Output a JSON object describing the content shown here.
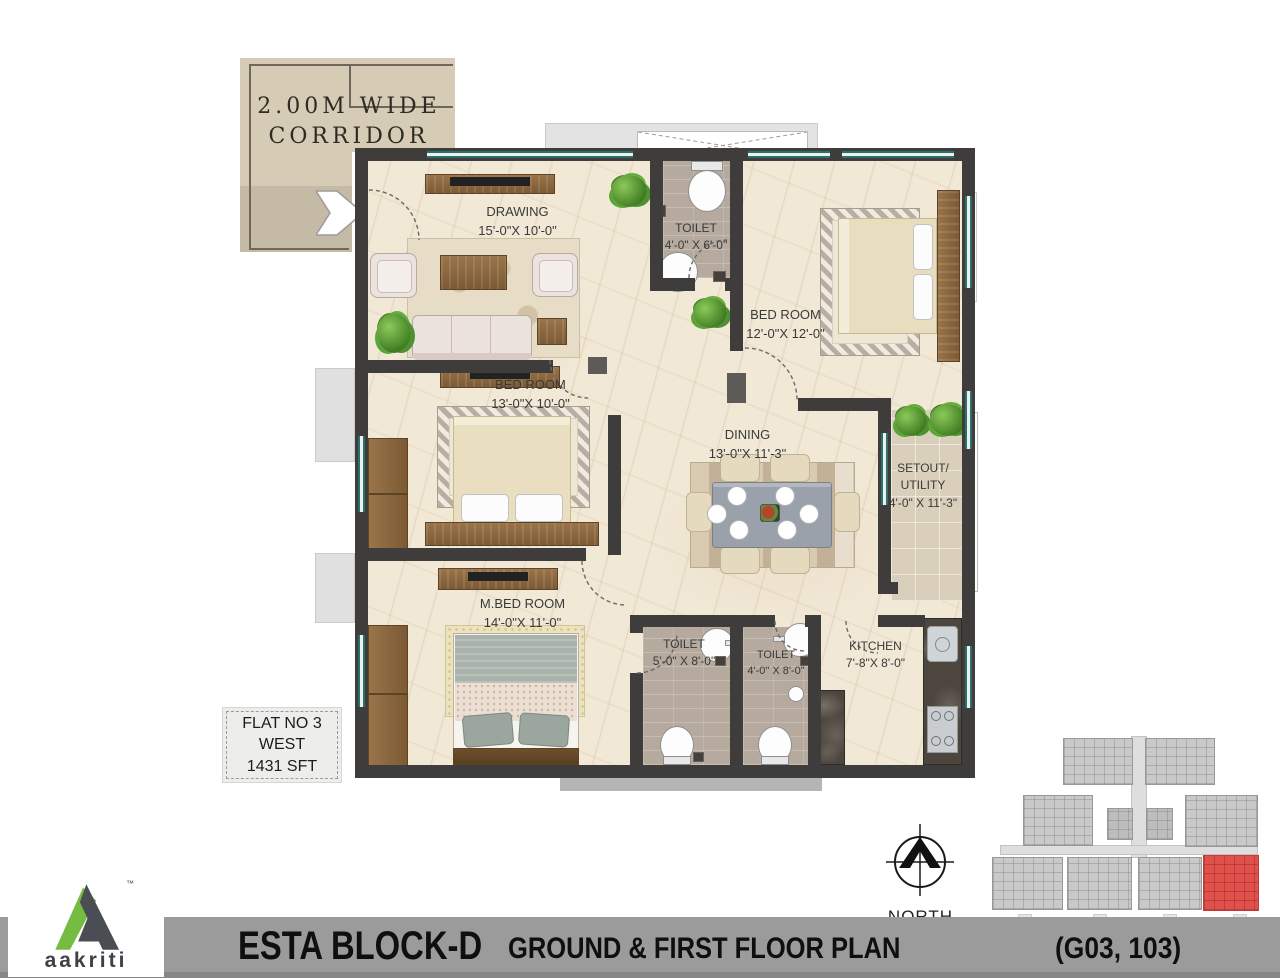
{
  "corridor": {
    "label_line1": "2.00M WIDE",
    "label_line2": "CORRIDOR"
  },
  "rooms": {
    "drawing": {
      "name": "DRAWING",
      "size": "15'-0\"X 10'-0\""
    },
    "toilet_top": {
      "name": "TOILET",
      "size": "4'-0\" X 6'-0\""
    },
    "bedroom1": {
      "name": "BED ROOM",
      "size": "12'-0\"X 12'-0\""
    },
    "bedroom2": {
      "name": "BED ROOM",
      "size": "13'-0\"X 10'-0\""
    },
    "dining": {
      "name": "DINING",
      "size": "13'-0\"X 11'-3\""
    },
    "setout": {
      "name_line1": "SETOUT/",
      "name_line2": "UTILITY",
      "size": "4'-0\" X 11'-3\""
    },
    "master_bedroom": {
      "name": "M.BED ROOM",
      "size": "14'-0\"X 11'-0\""
    },
    "toilet2": {
      "name": "TOILET",
      "size": "5'-0\" X 8'-0\""
    },
    "toilet3": {
      "name": "TOILET",
      "size": "4'-0\" X 8'-0\""
    },
    "kitchen": {
      "name": "KITCHEN",
      "size": "7'-8\"X 8'-0\""
    }
  },
  "flat_info": {
    "line1": "FLAT NO 3",
    "line2": "WEST",
    "line3": "1431 SFT"
  },
  "compass": {
    "label": "NORTH"
  },
  "footer": {
    "block": "ESTA BLOCK-D",
    "plan": "GROUND & FIRST FLOOR PLAN",
    "units": "(G03, 103)"
  },
  "logo": {
    "brand": "aakriti",
    "tm": "™"
  },
  "colors": {
    "wall": "#3f3d3b",
    "floor": "#f1e8d6",
    "window": "#2e6f6a",
    "accent_green": "#76bc43",
    "logo_dark": "#4a4e54",
    "keyplan_red": "#e0514c",
    "bar_gray": "#9b9b9b"
  }
}
